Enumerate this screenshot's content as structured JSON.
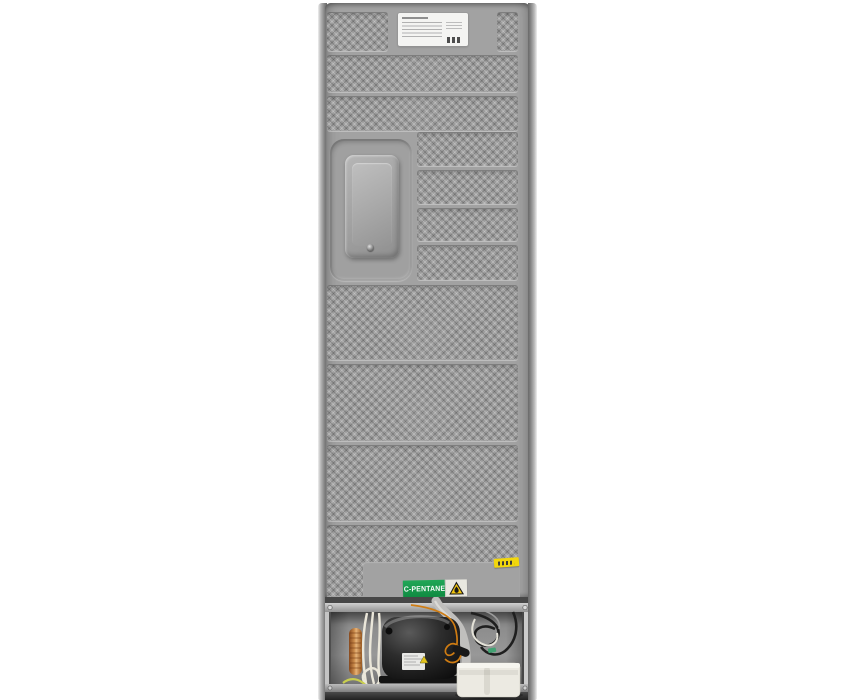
{
  "scene": {
    "subject": "refrigerator-rear-view-photo",
    "background_color": "#ffffff"
  },
  "panel": {
    "base_color": "#a2a2a2",
    "texture_style": "diamond-knurled-bands"
  },
  "rating_plate": {
    "bg_color": "#f4f4f2"
  },
  "refrigerant_label": {
    "text": "C-PENTANE",
    "bg_color": "#169a4b",
    "text_color": "#ffffff",
    "icon": "flammable-warning-triangle-icon",
    "icon_panel_color": "#e9e8e0",
    "triangle_color": "#f2c50e"
  },
  "service_sticker": {
    "bg_color": "#f2d70c"
  },
  "compartment": {
    "wall_color": "#8f8f8f",
    "compressor_color": "#1c1c1c",
    "copper_coil_color": "#c98a4a",
    "capillary_color": "#cf7c12",
    "drain_hose_color": "#c0bfbd",
    "tray_color": "#eceae2"
  }
}
